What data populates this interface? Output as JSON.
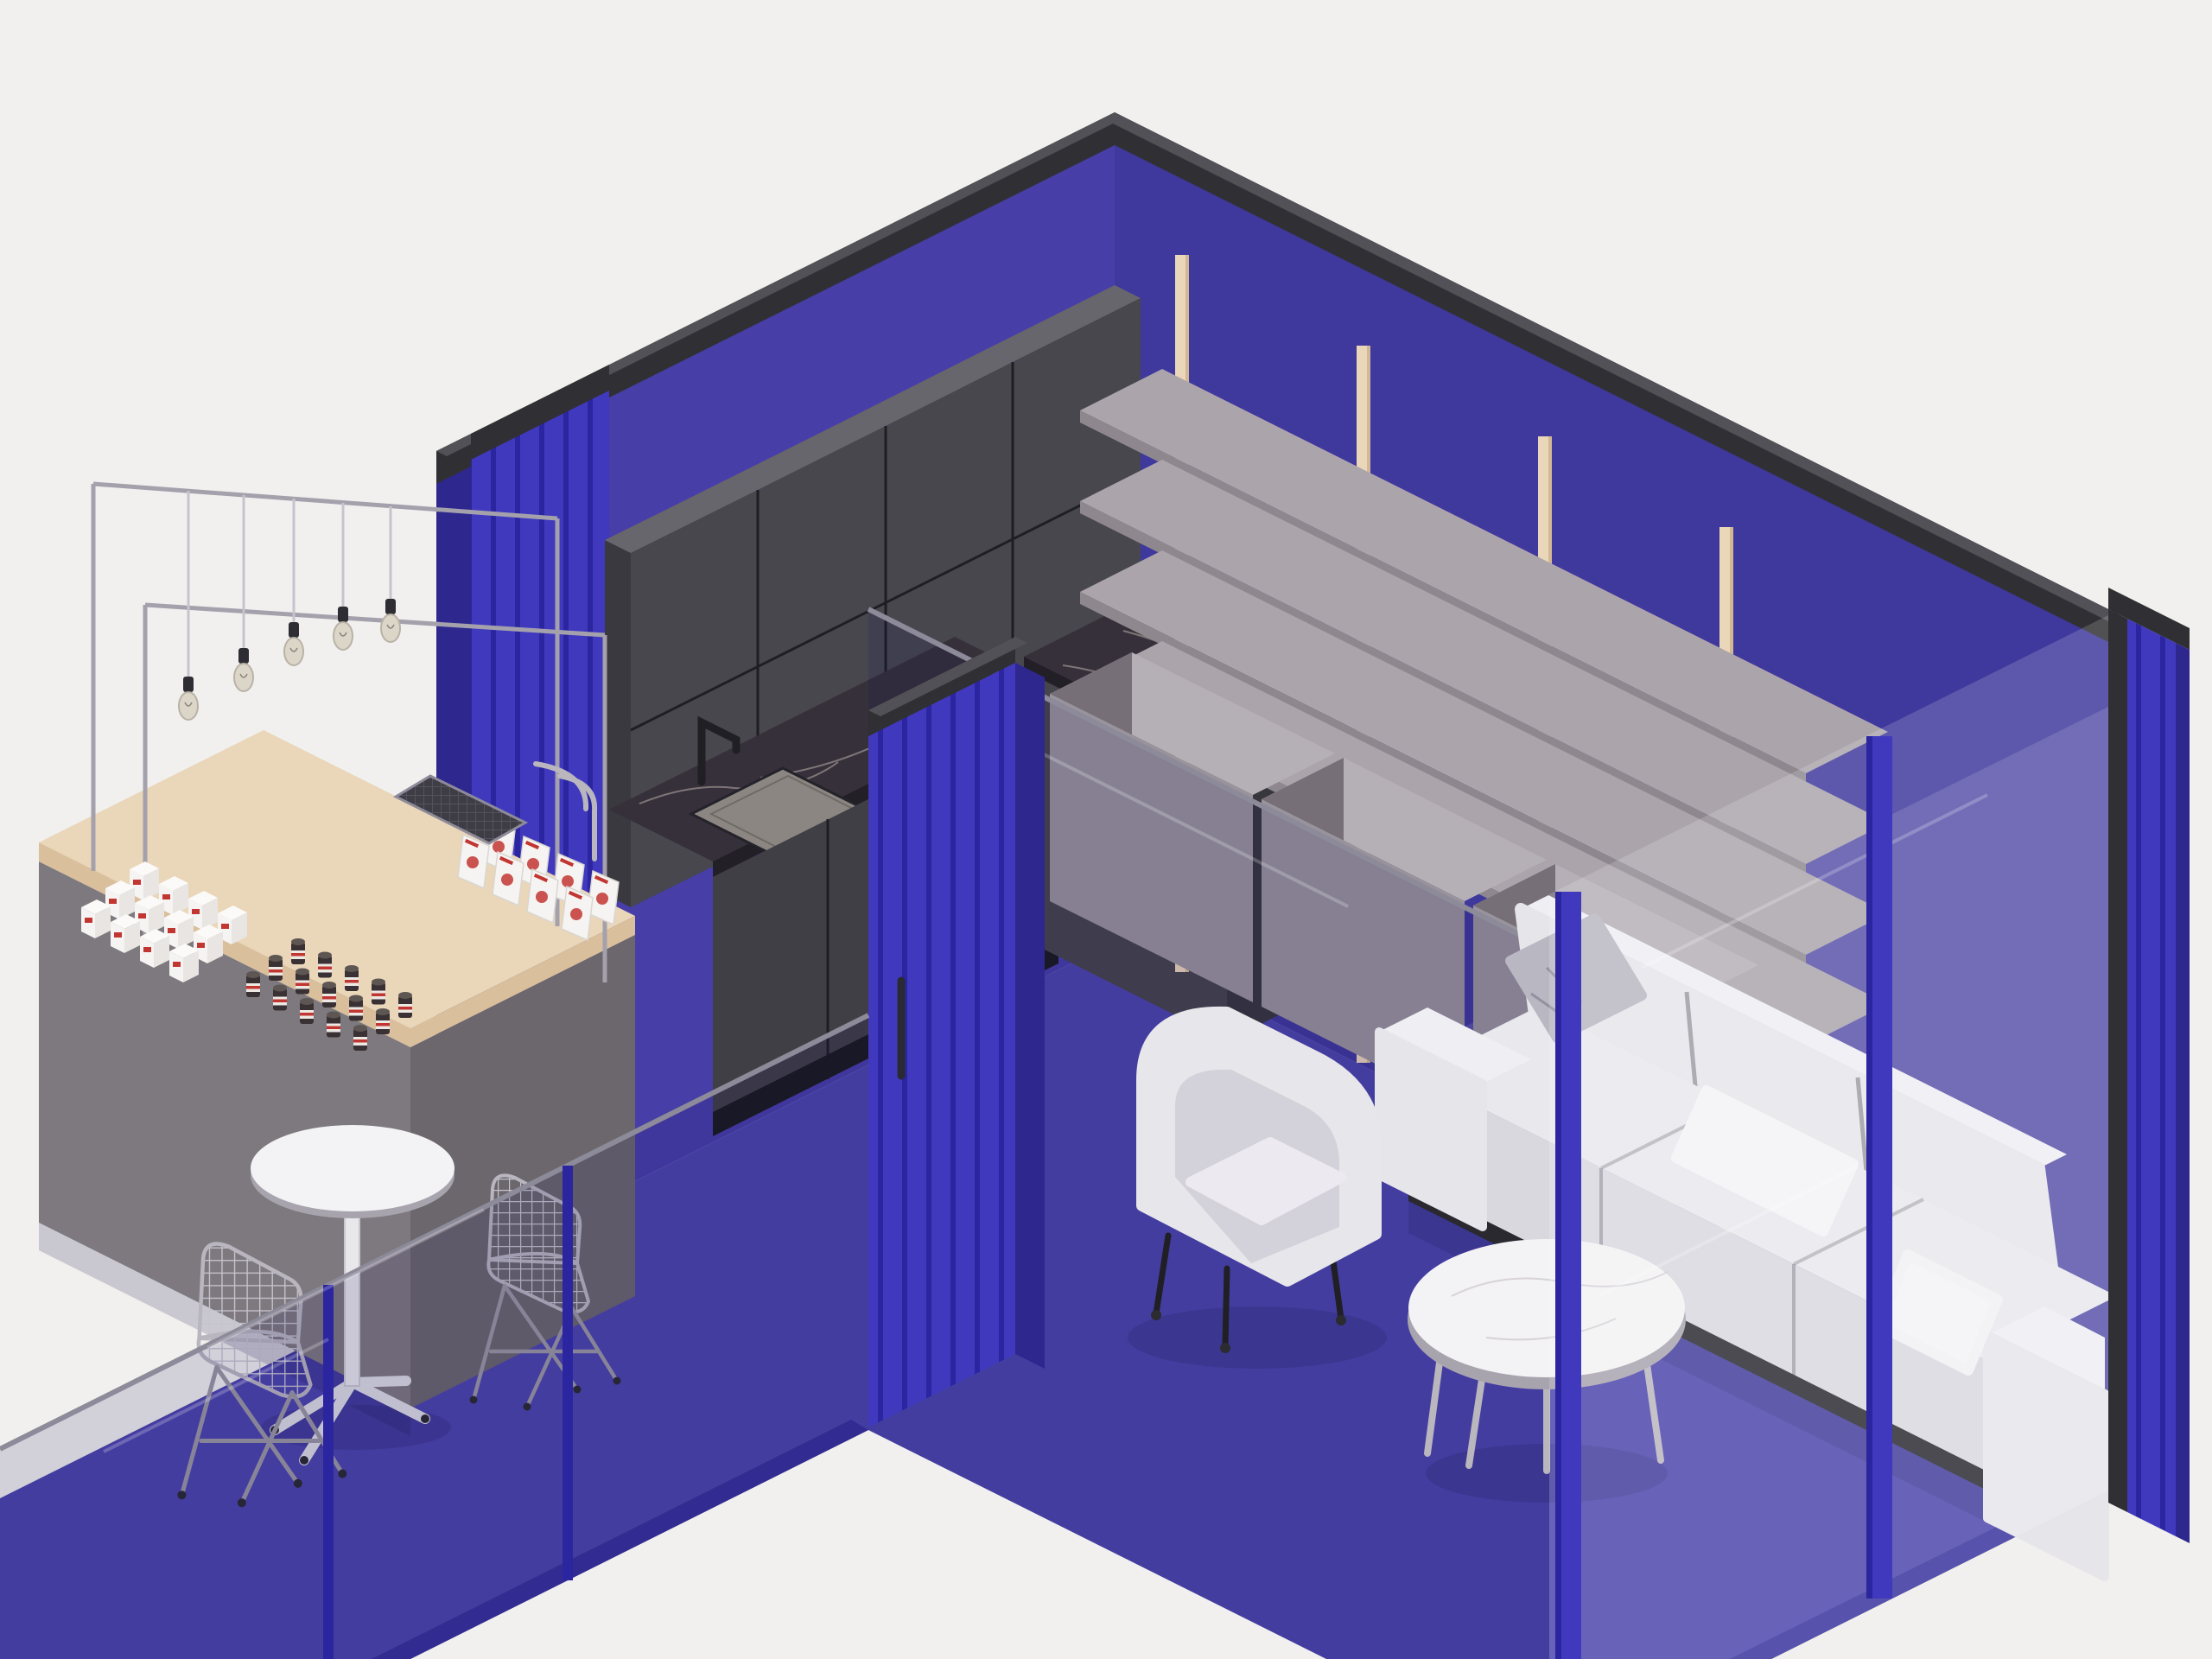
{
  "title": "Isometric café and lounge interior render",
  "colors": {
    "bg": "#f1f0ee",
    "wall_left": "#473EA8",
    "wall_right": "#3F389D",
    "floor": "#4C45AC",
    "floor_edge": "#37319B",
    "trim": "#303034",
    "trim_top": "#515157",
    "accent": "#4039BE",
    "accent_dark": "#2B25A0",
    "accent_side": "#2E288E",
    "cabinet_front": "#48474D",
    "cabinet_top": "#67666C",
    "cabinet_side": "#3A393F",
    "cabinet_seam": "#1E1E23",
    "marble_dark": "#36303A",
    "marble_edge": "#221F26",
    "marble_vein": "#B9AFA9",
    "sink": "#8B8681",
    "base_front": "#403F45",
    "toekick": "#1A1A1E",
    "island_front": "#46454B",
    "island_side": "#38373D",
    "wood_post": "#EAD6B8",
    "wood_shade": "#D2B894",
    "shelf_top": "#ABA5AB",
    "shelf_edge": "#8E888E",
    "box_top": "#B5B0B6",
    "box_front": "#99939B",
    "box_side": "#766F78",
    "sofa_light": "#E6E5EA",
    "sofa_mid": "#D9D8DF",
    "sofa_hi": "#EFEEF2",
    "sofa_top": "#E9E8ED",
    "plinth": "#2A2930",
    "pillow_gray": "#B9B7C1",
    "pillow_white": "#F4F3F6",
    "chair_fabric": "#E7E6EA",
    "chair_inner": "#D3D1DA",
    "chair_cushion": "#ECEAF0",
    "leg_dark": "#1F1F24",
    "chrome": "#B9B6BE",
    "table_white": "#F3F2F4",
    "table_under": "#A8A4AE",
    "kiosk_front": "#7E797E",
    "kiosk_side": "#6C676C",
    "kiosk_wood": "#EAD6B8",
    "kiosk_wood_edge": "#D9BF9C",
    "frame_gray": "#A4A1AC",
    "rail": "#8D8A99",
    "glass_dark": "rgba(22,16,92,0.14)",
    "glass_white": "rgba(255,255,255,0.16)",
    "wire": "#C6C3CD",
    "product_white": "#F6F4F2",
    "product_red": "#C23632",
    "jar_dark": "#3A3134",
    "jar_label": "#ECE8E4",
    "bulb_glass": "#DCD6C9",
    "bulb_socket": "#2E2D33",
    "mesh_dark": "#3E3C44"
  },
  "scene": {
    "style": "isometric 3D interior render, 2:1 axonometric projection",
    "rooms": [
      "cafe corner with retail kiosk",
      "kitchenette",
      "glass-enclosed lounge"
    ],
    "objects": [
      "purple back walls with dark top trim",
      "ribbed bright-blue wall pilasters",
      "dark gray upper kitchen cabinets (4 x 2 doors)",
      "dark marble countertop with undermount sink and black faucet",
      "dark marble kitchen island",
      "wood-post shelving unit with 4 staggered gray shelf rows",
      "3 gray storage boxes under shelving",
      "white 3-seat fabric sofa with pillows",
      "white fabric tub armchair with black metal legs",
      "round white marble coffee table with chrome legs",
      "retail kiosk counter: gray body, wood top, glass display frames",
      "white product boxes with red branding, jars with dark lids",
      "wire storage basket, chrome rail",
      "5 pendant filament bulbs on wires",
      "round white pedestal cafe table",
      "2 wire mesh chairs with eiffel bases",
      "glass balustrade and full-height glass partitions with blue mullions"
    ]
  },
  "decor": {
    "bulbs": [
      [
        218,
        823
      ],
      [
        282,
        790
      ],
      [
        340,
        760
      ],
      [
        397,
        742
      ],
      [
        452,
        733
      ]
    ],
    "bulb_wire_tops": [
      [
        218,
        568
      ],
      [
        282,
        573
      ],
      [
        340,
        577
      ],
      [
        397,
        582
      ],
      [
        452,
        586
      ]
    ],
    "box_grid": {
      "origin": [
        150,
        1006
      ],
      "cols": 4,
      "rows": 3,
      "col_step": [
        34,
        17
      ],
      "row_step": [
        -28,
        22
      ]
    },
    "jar_grid": {
      "origin": [
        345,
        1090
      ],
      "cols": 5,
      "rows": 3,
      "col_step": [
        31,
        15.5
      ],
      "row_step": [
        -26,
        19
      ]
    },
    "pack_grid": {
      "origin": [
        566,
        948
      ],
      "cols": 4,
      "rows": 2,
      "col_step": [
        40,
        20
      ],
      "row_step": [
        -30,
        18
      ]
    }
  }
}
